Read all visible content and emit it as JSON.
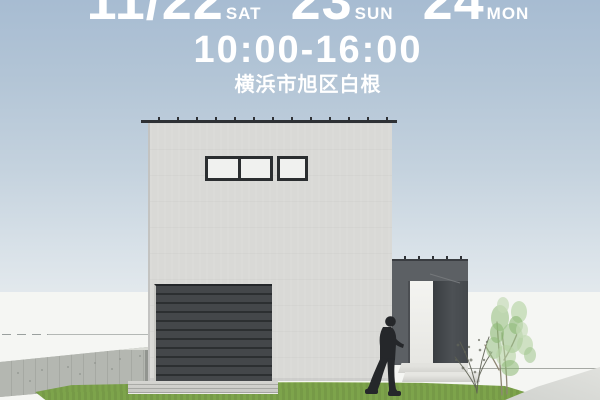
{
  "header": {
    "date_month_day": "11/22",
    "day1_label": "SAT",
    "day2": "23",
    "day2_label": "SUN",
    "day3": "24",
    "day3_label": "MON",
    "time": "10:00-16:00",
    "location": "横浜市旭区白根"
  },
  "colors": {
    "sky_top": "#a7bcd2",
    "sky_bottom": "#f0f2f2",
    "text": "#ffffff",
    "house_wall": "#d9d9d6",
    "roof_edge": "#2e3135",
    "window_frame": "#2b2e30",
    "garage_door": "#3e4144",
    "entrance_gate": "#5c6064",
    "lawn": "#7da44b",
    "concrete_fence": "#b0b3ad",
    "backdrop": "#f5f6f3",
    "person": "#25272a",
    "tree_foliage": "#9fc58c"
  },
  "scene": {
    "illustration": "3D exterior rendering of a modern flat-roof house with garage, entrance gate, person, trees and lawn"
  }
}
